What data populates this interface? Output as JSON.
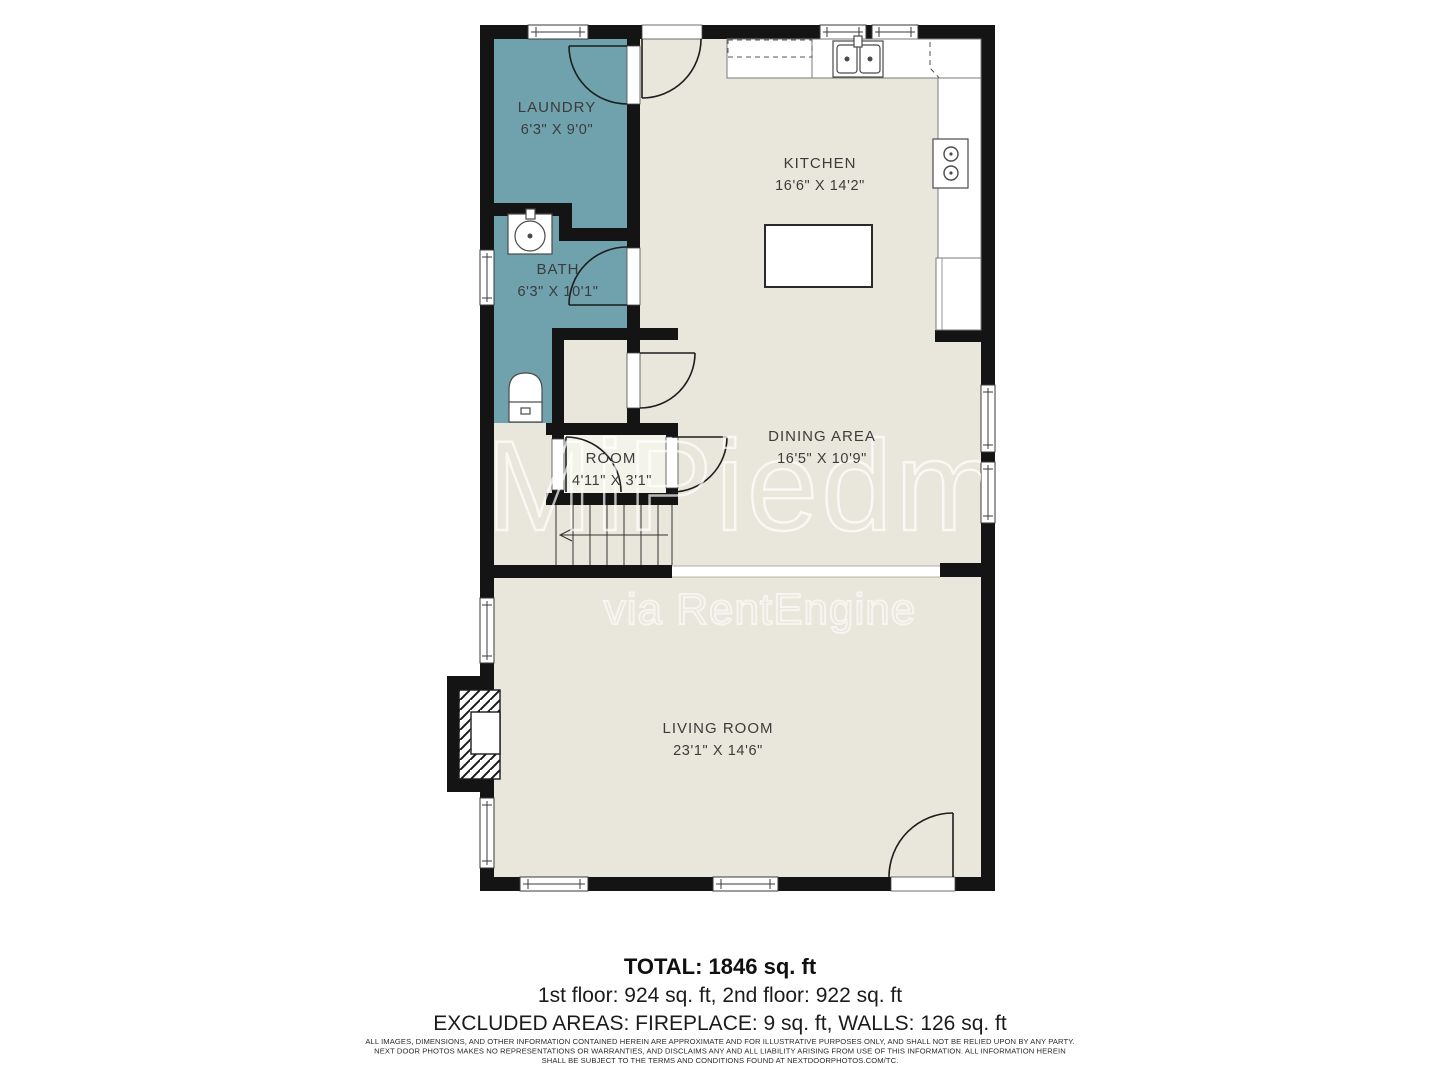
{
  "floorplan": {
    "rooms": [
      {
        "name": "LAUNDRY",
        "dims": "6'3\" X 9'0\""
      },
      {
        "name": "KITCHEN",
        "dims": "16'6\" X 14'2\""
      },
      {
        "name": "BATH",
        "dims": "6'3\" X 10'1\""
      },
      {
        "name": "DINING AREA",
        "dims": "16'5\" X 10'9\""
      },
      {
        "name": "ROOM",
        "dims": "4'11\" X 3'1\""
      },
      {
        "name": "LIVING ROOM",
        "dims": "23'1\" X 14'6\""
      }
    ],
    "watermark": {
      "line1": "MiPiedmo",
      "line2": "via RentEngine"
    },
    "colors": {
      "floor": "#e9e7db",
      "room_floor": "#f4f3ea",
      "wet_room": "#6fa2ac",
      "wall": "#141414"
    }
  },
  "summary": {
    "total": "TOTAL: 1846 sq. ft",
    "floors": "1st floor: 924 sq. ft, 2nd floor: 922 sq. ft",
    "excluded": "EXCLUDED AREAS: FIREPLACE: 9 sq. ft, WALLS: 126 sq. ft",
    "disclaimer": {
      "line1": "ALL IMAGES, DIMENSIONS, AND OTHER INFORMATION CONTAINED HEREIN ARE APPROXIMATE AND FOR ILLUSTRATIVE PURPOSES ONLY, AND SHALL NOT BE RELIED UPON BY ANY PARTY.",
      "line2": "NEXT DOOR PHOTOS MAKES NO REPRESENTATIONS OR WARRANTIES, AND DISCLAIMS ANY AND ALL LIABILITY ARISING FROM USE OF THIS INFORMATION. ALL INFORMATION HEREIN",
      "line3": "SHALL BE SUBJECT TO THE TERMS AND CONDITIONS FOUND AT NEXTDOORPHOTOS.COM/TC."
    }
  }
}
